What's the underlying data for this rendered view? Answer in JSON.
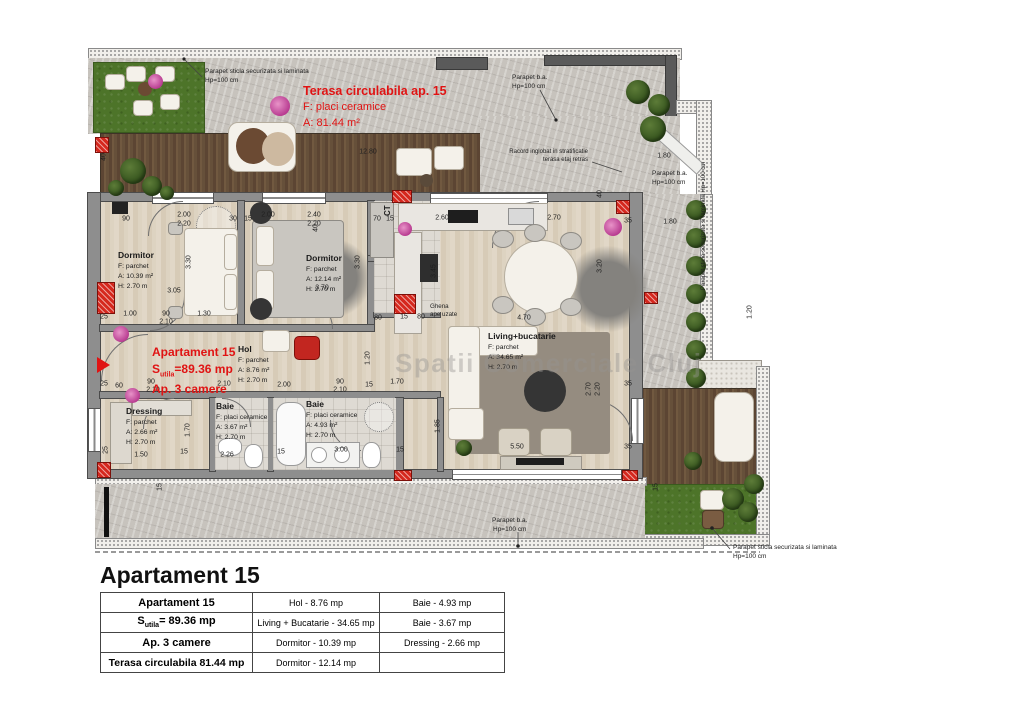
{
  "watermark": {
    "text": "Spatii Comerciale Cluj"
  },
  "callouts": {
    "top_left_parapet": {
      "l1": "Parapet sticla securizata si laminata",
      "l2": "Hp=100 cm"
    },
    "top_right_parapet": {
      "l1": "Parapet b.a.",
      "l2": "Hp=100 cm"
    },
    "racord": {
      "l1": "Racord inglobat in stratificatie",
      "l2": "terasa etaj retras"
    },
    "stair_parapet": {
      "l1": "Parapet b.a.",
      "l2": "Hp=100 cm"
    },
    "right_parapet": {
      "l1": "Parapet sticla securizata si laminata Hp=100 cm"
    },
    "bottom_parapet": {
      "l1": "Parapet b.a.",
      "l2": "Hp=100 cm"
    },
    "bottom_right_parapet": {
      "l1": "Parapet sticla securizata si laminata",
      "l2": "Hp=100 cm"
    }
  },
  "terrace_label": {
    "line1": "Terasa circulabila ap. 15",
    "line2": "F: placi ceramice",
    "line3": "A: 81.44 m²"
  },
  "apartment_label": {
    "line1": "Apartament 15",
    "s_pre": "S",
    "s_sub": "utila",
    "s_post": "=89.36 mp",
    "line3": "Ap. 3 camere"
  },
  "rooms": {
    "dormitor1": {
      "name": "Dormitor",
      "f": "F: parchet",
      "a": "A: 10.39 m²",
      "h": "H: 2.70 m"
    },
    "dormitor2": {
      "name": "Dormitor",
      "f": "F: parchet",
      "a": "A: 12.14 m²",
      "h": "H: 2.70 m"
    },
    "hol": {
      "name": "Hol",
      "f": "F: parchet",
      "a": "A: 8.76 m²",
      "h": "H: 2.70 m"
    },
    "living": {
      "name": "Living+bucatarie",
      "f": "F: parchet",
      "a": "A: 34.65 m²",
      "h": "H: 2.70 m"
    },
    "dressing": {
      "name": "Dressing",
      "f": "F: parchet",
      "a": "A: 2.66 m²",
      "h": "H: 2.70 m"
    },
    "baie1": {
      "name": "Baie",
      "f": "F: placi ceramice",
      "a": "A: 3.67 m²",
      "h": "H: 2.70 m"
    },
    "baie2": {
      "name": "Baie",
      "f": "F: placi ceramice",
      "a": "A: 4.93 m²",
      "h": "H: 2.70 m"
    },
    "ct": {
      "name": "CT"
    },
    "ghena": {
      "l1": "Ghena",
      "l2": "ape uzate"
    }
  },
  "dims": [
    {
      "t": "40",
      "x": 104,
      "y": 157,
      "r": 1
    },
    {
      "t": "12.80",
      "x": 368,
      "y": 152
    },
    {
      "t": "1.80",
      "x": 664,
      "y": 156
    },
    {
      "t": "40",
      "x": 600,
      "y": 194,
      "r": 1
    },
    {
      "t": "90",
      "x": 126,
      "y": 219
    },
    {
      "t": "2.00",
      "x": 184,
      "y": 215
    },
    {
      "t": "2.20",
      "x": 184,
      "y": 224
    },
    {
      "t": "30",
      "x": 233,
      "y": 219
    },
    {
      "t": "15",
      "x": 248,
      "y": 219
    },
    {
      "t": "2.00",
      "x": 268,
      "y": 215
    },
    {
      "t": "2.40",
      "x": 314,
      "y": 215
    },
    {
      "t": "2.20",
      "x": 314,
      "y": 224
    },
    {
      "t": "70",
      "x": 377,
      "y": 219
    },
    {
      "t": "15",
      "x": 390,
      "y": 219
    },
    {
      "t": "2.60",
      "x": 442,
      "y": 218
    },
    {
      "t": "2.70",
      "x": 554,
      "y": 218
    },
    {
      "t": "35",
      "x": 628,
      "y": 221
    },
    {
      "t": "1.80",
      "x": 670,
      "y": 222
    },
    {
      "t": "40",
      "x": 316,
      "y": 228,
      "r": 1
    },
    {
      "t": "3.30",
      "x": 189,
      "y": 262,
      "r": 1
    },
    {
      "t": "3.05",
      "x": 174,
      "y": 291
    },
    {
      "t": "3.30",
      "x": 358,
      "y": 262,
      "r": 1
    },
    {
      "t": "3.70",
      "x": 322,
      "y": 288
    },
    {
      "t": "3.45",
      "x": 434,
      "y": 271,
      "r": 1
    },
    {
      "t": "3.20",
      "x": 600,
      "y": 266,
      "r": 1
    },
    {
      "t": "25",
      "x": 104,
      "y": 317
    },
    {
      "t": "1.00",
      "x": 130,
      "y": 314
    },
    {
      "t": "90",
      "x": 166,
      "y": 314
    },
    {
      "t": "2.10",
      "x": 166,
      "y": 322
    },
    {
      "t": "1.30",
      "x": 204,
      "y": 314
    },
    {
      "t": "25",
      "x": 104,
      "y": 384
    },
    {
      "t": "60",
      "x": 119,
      "y": 386
    },
    {
      "t": "90",
      "x": 151,
      "y": 382
    },
    {
      "t": "2.10",
      "x": 153,
      "y": 390
    },
    {
      "t": "2.10",
      "x": 224,
      "y": 384
    },
    {
      "t": "2.00",
      "x": 284,
      "y": 385
    },
    {
      "t": "90",
      "x": 340,
      "y": 382
    },
    {
      "t": "2.10",
      "x": 340,
      "y": 390
    },
    {
      "t": "15",
      "x": 369,
      "y": 385
    },
    {
      "t": "80",
      "x": 378,
      "y": 318
    },
    {
      "t": "15",
      "x": 404,
      "y": 317
    },
    {
      "t": "80",
      "x": 421,
      "y": 317
    },
    {
      "t": "4.70",
      "x": 524,
      "y": 318
    },
    {
      "t": "1.20",
      "x": 368,
      "y": 358,
      "r": 1
    },
    {
      "t": "1.70",
      "x": 397,
      "y": 382
    },
    {
      "t": "1.85",
      "x": 438,
      "y": 426,
      "r": 1
    },
    {
      "t": "1.70",
      "x": 188,
      "y": 430,
      "r": 1
    },
    {
      "t": "1.50",
      "x": 141,
      "y": 455
    },
    {
      "t": "15",
      "x": 184,
      "y": 452
    },
    {
      "t": "2.26",
      "x": 227,
      "y": 455
    },
    {
      "t": "15",
      "x": 281,
      "y": 452
    },
    {
      "t": "3.00",
      "x": 341,
      "y": 450
    },
    {
      "t": "15",
      "x": 400,
      "y": 450
    },
    {
      "t": "5.50",
      "x": 517,
      "y": 447
    },
    {
      "t": "2.70",
      "x": 589,
      "y": 389,
      "r": 1
    },
    {
      "t": "2.20",
      "x": 598,
      "y": 389,
      "r": 1
    },
    {
      "t": "35",
      "x": 628,
      "y": 384
    },
    {
      "t": "35",
      "x": 628,
      "y": 447
    },
    {
      "t": "25",
      "x": 106,
      "y": 450,
      "r": 1
    },
    {
      "t": "15",
      "x": 160,
      "y": 487,
      "r": 1
    },
    {
      "t": "15",
      "x": 656,
      "y": 487,
      "r": 1
    },
    {
      "t": "1.20",
      "x": 750,
      "y": 312,
      "r": 1
    }
  ],
  "summary": {
    "title": "Apartament 15",
    "r1c1": "Apartament 15",
    "r1c2": "Hol - 8.76 mp",
    "r1c3": "Baie - 4.93 mp",
    "r2c1_pre": "S",
    "r2c1_sub": "utila",
    "r2c1_post": "= 89.36 mp",
    "r2c2": "Living + Bucatarie - 34.65 mp",
    "r2c3": "Baie - 3.67 mp",
    "r3c1": "Ap. 3 camere",
    "r3c2": "Dormitor - 10.39 mp",
    "r3c3": "Dressing - 2.66 mp",
    "r4c1": "Terasa circulabila 81.44 mp",
    "r4c2": "Dormitor - 12.14 mp",
    "r4c3": ""
  }
}
